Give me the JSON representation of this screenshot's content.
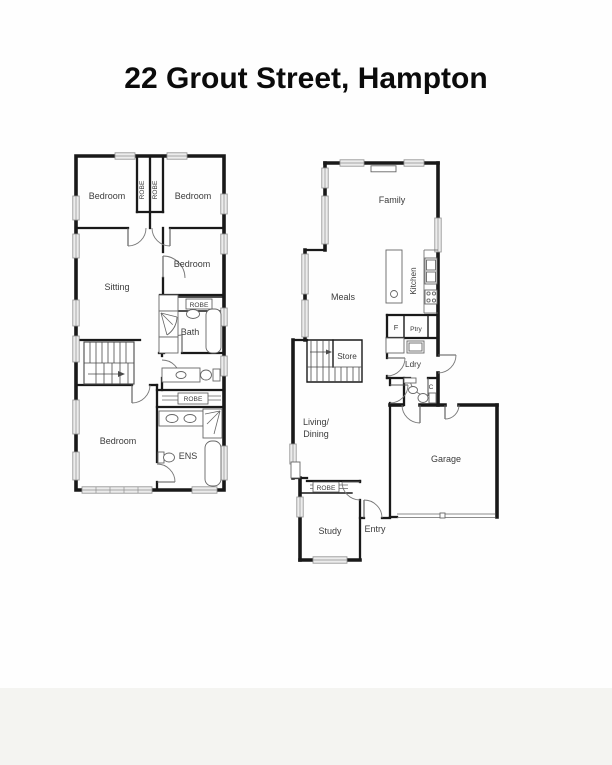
{
  "title": "22 Grout Street, Hampton",
  "colors": {
    "wall": "#191919",
    "label_text": "#3b3b3b",
    "window_fill": "#ececec",
    "background": "#fefefe"
  },
  "floors": {
    "upper": {
      "rooms": {
        "bedroom_top_left": "Bedroom",
        "robe_closet_left": "ROBE",
        "robe_closet_right": "ROBE",
        "bedroom_top_right": "Bedroom",
        "bedroom_middle": "Bedroom",
        "sitting": "Sitting",
        "robe_bath": "ROBE",
        "bath": "Bath",
        "robe_hall": "ROBE",
        "bedroom_master": "Bedroom",
        "ensuite": "ENS"
      }
    },
    "ground": {
      "rooms": {
        "family": "Family",
        "meals": "Meals",
        "kitchen": "Kitchen",
        "fridge": "F",
        "pantry": "Ptry",
        "store": "Store",
        "laundry": "Ldry",
        "wc": "C",
        "living_dining_line1": "Living/",
        "living_dining_line2": "Dining",
        "garage": "Garage",
        "robe_study": "ROBE",
        "study": "Study",
        "entry": "Entry"
      }
    }
  }
}
